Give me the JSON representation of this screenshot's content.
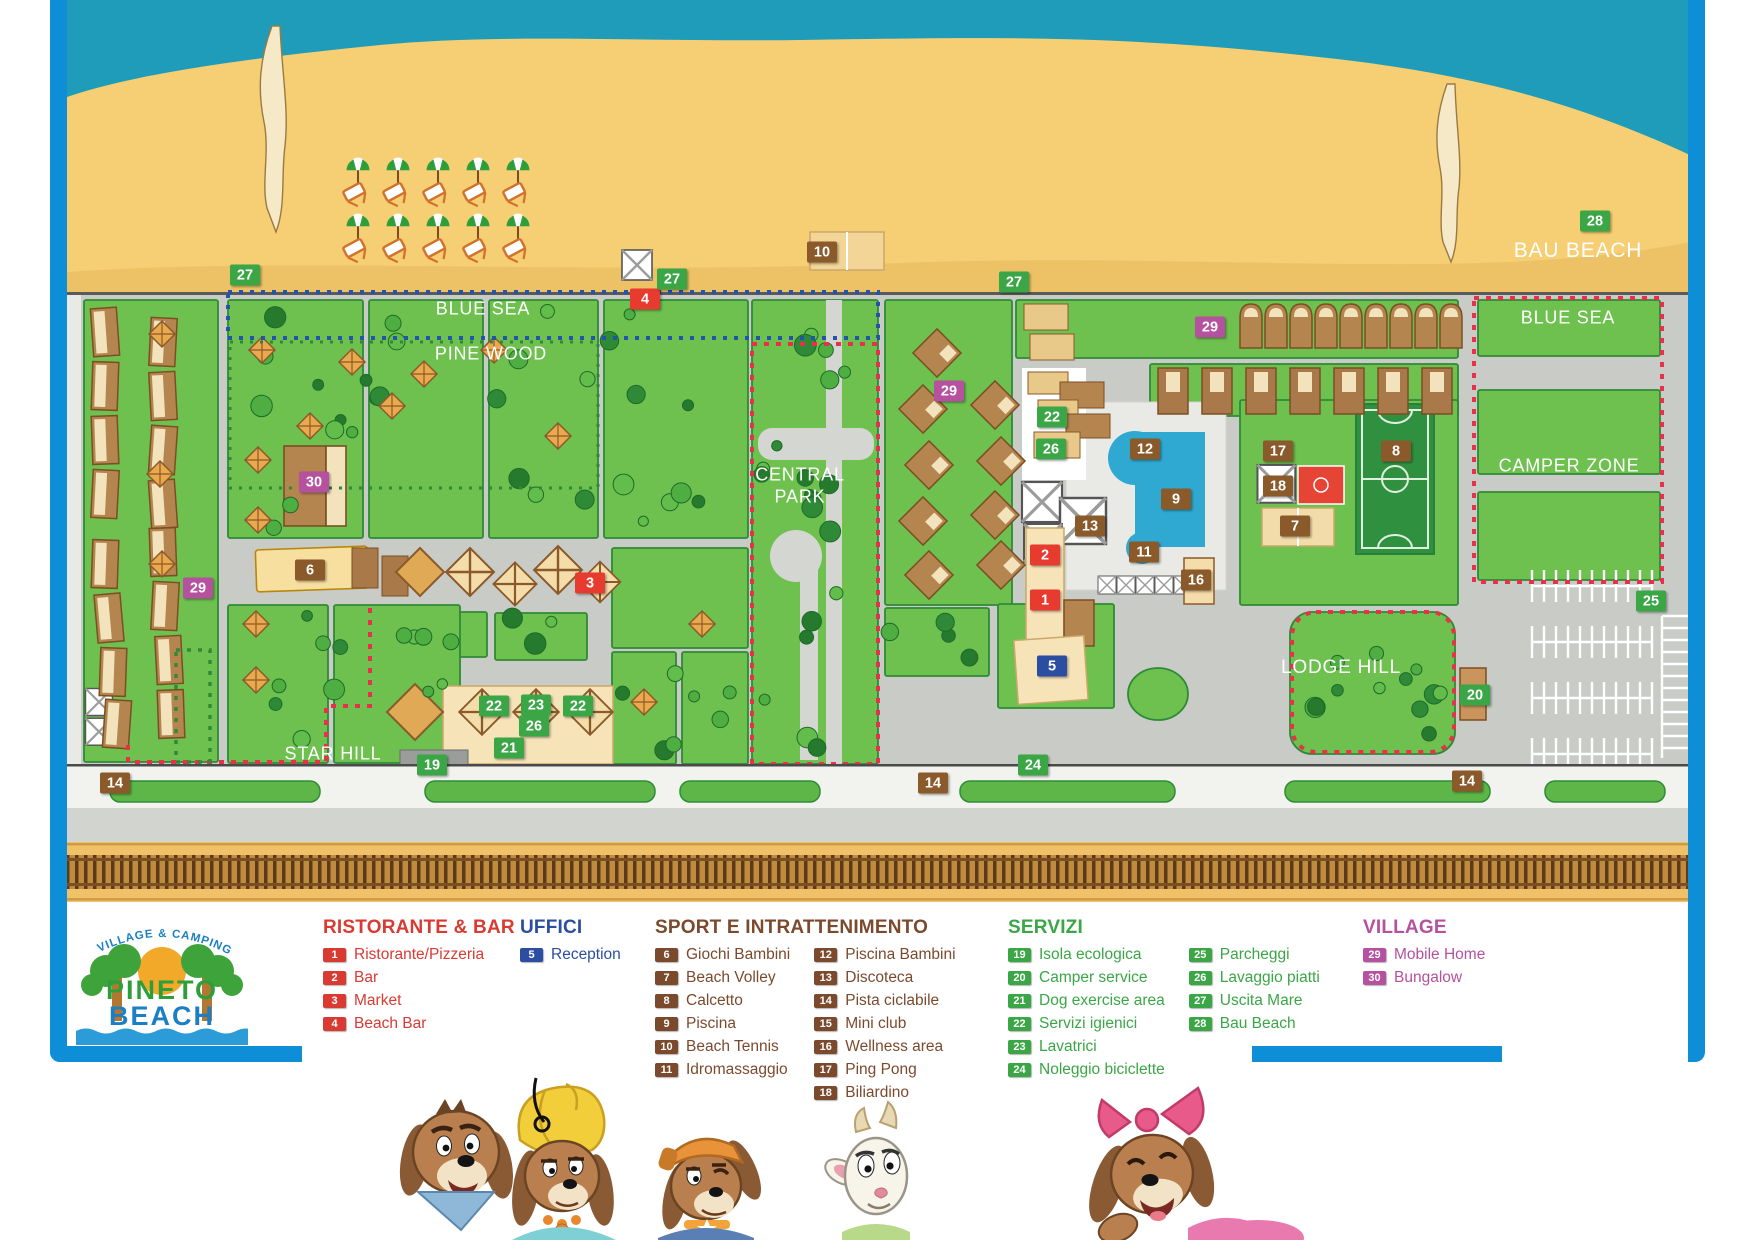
{
  "title": "Pineto Beach Village & Camping Map",
  "logo": {
    "tagline": "VILLAGE & CAMPING",
    "name_line1": "PINETO",
    "name_line2": "BEACH"
  },
  "palette": {
    "red": "#e63b2e",
    "green": "#3aa646",
    "brown": "#8a5a2b",
    "blue": "#2b4ea2",
    "purple": "#b5519e",
    "frame": "#0f8ed8",
    "sea": "#1e9cba",
    "sand": "#f6ce74",
    "grass": "#6ec04f",
    "road": "#c9cbc7"
  },
  "map": {
    "area_labels": [
      {
        "text": "BLUE SEA",
        "x": 483,
        "y": 309,
        "size": 18
      },
      {
        "text": "PINE WOOD",
        "x": 491,
        "y": 354,
        "size": 18
      },
      {
        "text": "CENTRAL",
        "x": 800,
        "y": 475,
        "size": 18
      },
      {
        "text": "PARK",
        "x": 800,
        "y": 497,
        "size": 18
      },
      {
        "text": "BAU BEACH",
        "x": 1578,
        "y": 251,
        "size": 21
      },
      {
        "text": "BLUE SEA",
        "x": 1568,
        "y": 318,
        "size": 18
      },
      {
        "text": "CAMPER ZONE",
        "x": 1569,
        "y": 466,
        "size": 18
      },
      {
        "text": "LODGE HILL",
        "x": 1341,
        "y": 668,
        "size": 19
      },
      {
        "text": "STAR HILL",
        "x": 333,
        "y": 754,
        "size": 18
      }
    ],
    "badges": [
      {
        "n": "27",
        "x": 245,
        "y": 275,
        "color": "green"
      },
      {
        "n": "4",
        "x": 645,
        "y": 299,
        "color": "red"
      },
      {
        "n": "27",
        "x": 672,
        "y": 279,
        "color": "green"
      },
      {
        "n": "10",
        "x": 822,
        "y": 252,
        "color": "brown"
      },
      {
        "n": "27",
        "x": 1014,
        "y": 282,
        "color": "green"
      },
      {
        "n": "28",
        "x": 1595,
        "y": 221,
        "color": "green"
      },
      {
        "n": "29",
        "x": 1210,
        "y": 327,
        "color": "purple"
      },
      {
        "n": "29",
        "x": 949,
        "y": 391,
        "color": "purple"
      },
      {
        "n": "22",
        "x": 1052,
        "y": 417,
        "color": "green"
      },
      {
        "n": "26",
        "x": 1051,
        "y": 449,
        "color": "green"
      },
      {
        "n": "12",
        "x": 1145,
        "y": 449,
        "color": "brown"
      },
      {
        "n": "9",
        "x": 1176,
        "y": 499,
        "color": "brown"
      },
      {
        "n": "17",
        "x": 1278,
        "y": 451,
        "color": "brown"
      },
      {
        "n": "18",
        "x": 1278,
        "y": 486,
        "color": "brown"
      },
      {
        "n": "7",
        "x": 1295,
        "y": 526,
        "color": "brown"
      },
      {
        "n": "8",
        "x": 1396,
        "y": 451,
        "color": "brown"
      },
      {
        "n": "13",
        "x": 1090,
        "y": 526,
        "color": "brown"
      },
      {
        "n": "11",
        "x": 1144,
        "y": 552,
        "color": "brown"
      },
      {
        "n": "2",
        "x": 1045,
        "y": 555,
        "color": "red"
      },
      {
        "n": "1",
        "x": 1045,
        "y": 600,
        "color": "red"
      },
      {
        "n": "16",
        "x": 1196,
        "y": 580,
        "color": "brown"
      },
      {
        "n": "5",
        "x": 1052,
        "y": 666,
        "color": "blue"
      },
      {
        "n": "30",
        "x": 314,
        "y": 482,
        "color": "purple"
      },
      {
        "n": "6",
        "x": 310,
        "y": 570,
        "color": "brown"
      },
      {
        "n": "3",
        "x": 590,
        "y": 583,
        "color": "red"
      },
      {
        "n": "29",
        "x": 198,
        "y": 588,
        "color": "purple"
      },
      {
        "n": "22",
        "x": 494,
        "y": 706,
        "color": "green"
      },
      {
        "n": "23",
        "x": 536,
        "y": 705,
        "color": "green"
      },
      {
        "n": "22",
        "x": 578,
        "y": 706,
        "color": "green"
      },
      {
        "n": "26",
        "x": 534,
        "y": 726,
        "color": "green"
      },
      {
        "n": "21",
        "x": 509,
        "y": 748,
        "color": "green"
      },
      {
        "n": "19",
        "x": 432,
        "y": 765,
        "color": "green"
      },
      {
        "n": "24",
        "x": 1033,
        "y": 765,
        "color": "green"
      },
      {
        "n": "20",
        "x": 1475,
        "y": 695,
        "color": "green"
      },
      {
        "n": "25",
        "x": 1651,
        "y": 601,
        "color": "green"
      },
      {
        "n": "14",
        "x": 115,
        "y": 783,
        "color": "brown"
      },
      {
        "n": "14",
        "x": 933,
        "y": 783,
        "color": "brown"
      },
      {
        "n": "14",
        "x": 1467,
        "y": 781,
        "color": "brown"
      }
    ]
  },
  "legend": {
    "sections": [
      {
        "title": "RISTORANTE & BAR",
        "color": "#d93a31",
        "x": 323,
        "y": 917,
        "columns": [
          [
            {
              "n": "1",
              "label": "Ristorante/Pizzeria"
            },
            {
              "n": "2",
              "label": "Bar"
            },
            {
              "n": "3",
              "label": "Market"
            },
            {
              "n": "4",
              "label": "Beach Bar"
            }
          ]
        ]
      },
      {
        "title": "UFFICI",
        "color": "#2b4ea2",
        "x": 520,
        "y": 917,
        "columns": [
          [
            {
              "n": "5",
              "label": "Reception"
            }
          ]
        ]
      },
      {
        "title": "SPORT E INTRATTENIMENTO",
        "color": "#7b4a2d",
        "x": 655,
        "y": 917,
        "columns": [
          [
            {
              "n": "6",
              "label": "Giochi Bambini"
            },
            {
              "n": "7",
              "label": "Beach Volley"
            },
            {
              "n": "8",
              "label": "Calcetto"
            },
            {
              "n": "9",
              "label": "Piscina"
            },
            {
              "n": "10",
              "label": "Beach Tennis"
            },
            {
              "n": "11",
              "label": "Idromassaggio"
            }
          ],
          [
            {
              "n": "12",
              "label": "Piscina Bambini"
            },
            {
              "n": "13",
              "label": "Discoteca"
            },
            {
              "n": "14",
              "label": "Pista ciclabile"
            },
            {
              "n": "15",
              "label": "Mini club"
            },
            {
              "n": "16",
              "label": "Wellness area"
            },
            {
              "n": "17",
              "label": "Ping Pong"
            },
            {
              "n": "18",
              "label": "Biliardino"
            }
          ]
        ]
      },
      {
        "title": "SERVIZI",
        "color": "#3aa646",
        "x": 1008,
        "y": 917,
        "columns": [
          [
            {
              "n": "19",
              "label": "Isola ecologica"
            },
            {
              "n": "20",
              "label": "Camper service"
            },
            {
              "n": "21",
              "label": "Dog exercise area"
            },
            {
              "n": "22",
              "label": "Servizi igienici"
            },
            {
              "n": "23",
              "label": "Lavatrici"
            },
            {
              "n": "24",
              "label": "Noleggio biciclette"
            }
          ],
          [
            {
              "n": "25",
              "label": "Parcheggi"
            },
            {
              "n": "26",
              "label": "Lavaggio piatti"
            },
            {
              "n": "27",
              "label": "Uscita Mare"
            },
            {
              "n": "28",
              "label": "Bau Beach"
            }
          ]
        ]
      },
      {
        "title": "VILLAGE",
        "color": "#b5519e",
        "x": 1363,
        "y": 917,
        "columns": [
          [
            {
              "n": "29",
              "label": "Mobile Home"
            },
            {
              "n": "30",
              "label": "Bungalow"
            }
          ]
        ]
      }
    ]
  }
}
